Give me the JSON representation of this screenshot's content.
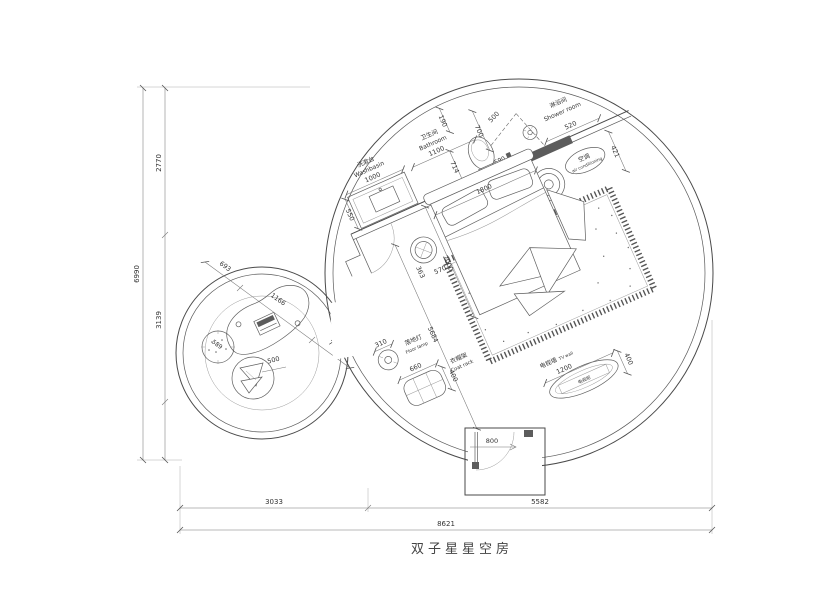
{
  "title": "双子星星空房",
  "labels": {
    "washbasin_zh": "洗漱台",
    "washbasin_en": "Washbasin",
    "bathroom_zh": "卫生间",
    "bathroom_en": "Bathroom",
    "shower_zh": "淋浴间",
    "shower_en": "Shower room",
    "ac_zh": "空调",
    "ac_en": "air conditioning",
    "lamp_zh": "落地灯",
    "lamp_en": "Floor lamp",
    "coat_zh": "衣帽架",
    "coat_en": "Coat rack",
    "tvwall_zh": "电视墙",
    "tvwall_en": "TV wall",
    "tvcab_zh": "电视柜"
  },
  "dims": {
    "h_total": "6990",
    "h_top": "2770",
    "h_bottom": "3139",
    "w_left": "3033",
    "w_right": "5582",
    "w_total": "8621",
    "washbasin_w": "1000",
    "washbasin_d": "550",
    "toilet_clear": "714",
    "bathroom_w": "1100",
    "wall_top": "190",
    "toilet_w": "700",
    "shower_glass": "500",
    "shower_w": "520",
    "ac_d": "421",
    "wall_niche": "590",
    "bed_w": "1800",
    "bed_l": "2000",
    "stool_a": "363",
    "stool_b": "570",
    "room_diag": "5684",
    "lamp_d": "310",
    "coat_w": "660",
    "coat_d": "400",
    "tv_w": "1200",
    "tv_d": "400",
    "door_w": "800",
    "desk_a": "693",
    "desk_b": "1166",
    "desk_c": "745",
    "pouf_d": "589",
    "basket_d": "500"
  }
}
